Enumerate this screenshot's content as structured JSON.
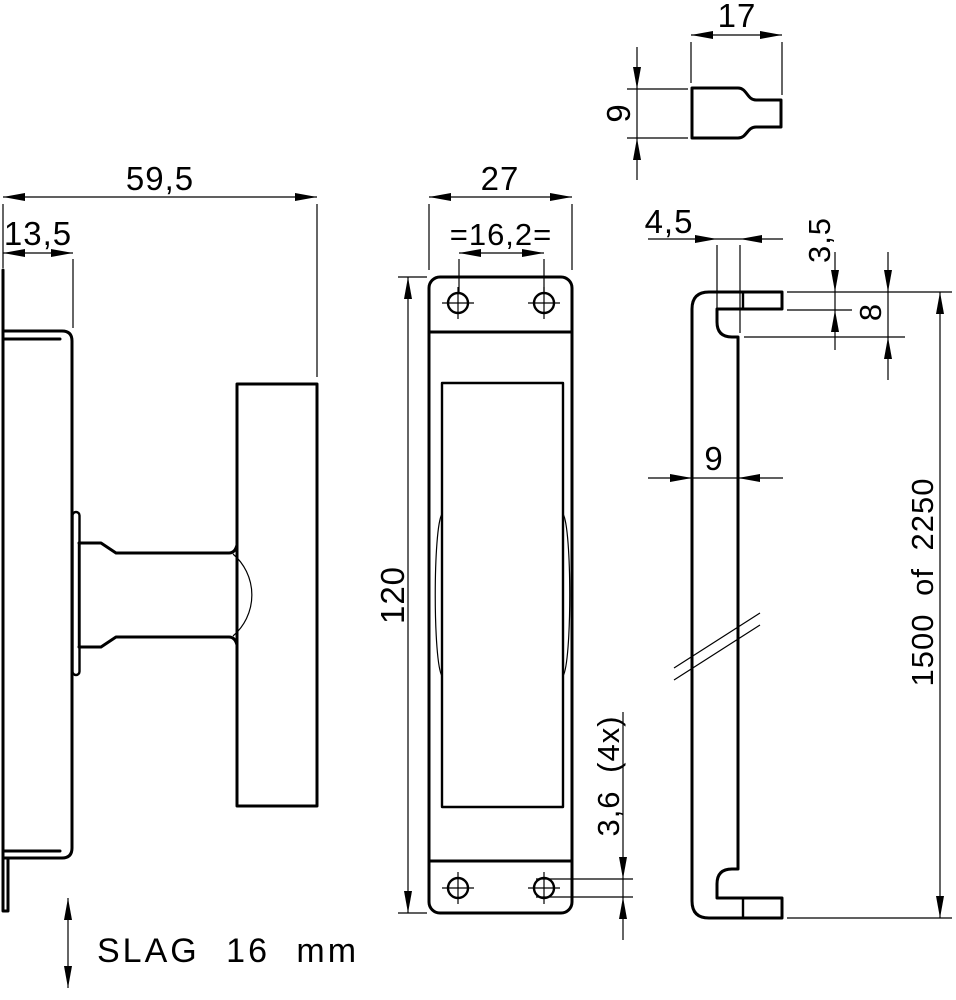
{
  "drawing": {
    "type": "technical-drawing",
    "colors": {
      "line": "#000000",
      "background": "#ffffff"
    },
    "views": {
      "side": {
        "label": "side-view-with-handle",
        "dims": {
          "overall_depth": "59,5",
          "case_depth": "13,5"
        },
        "note": "SLAG 16 mm"
      },
      "front": {
        "label": "front-view-faceplate",
        "dims": {
          "width": "27",
          "hole_pitch": "=16,2=",
          "height": "120",
          "hole_diameter": "3,6 (4x)"
        }
      },
      "rod": {
        "label": "locking-rod-profile",
        "dims": {
          "hook_offset": "4,5",
          "lip_thickness": "3,5",
          "hook_height": "8",
          "rod_width": "9",
          "length": "1500 of 2250"
        }
      },
      "detail": {
        "label": "end-pin-detail",
        "dims": {
          "length": "17",
          "width": "9"
        }
      }
    }
  }
}
